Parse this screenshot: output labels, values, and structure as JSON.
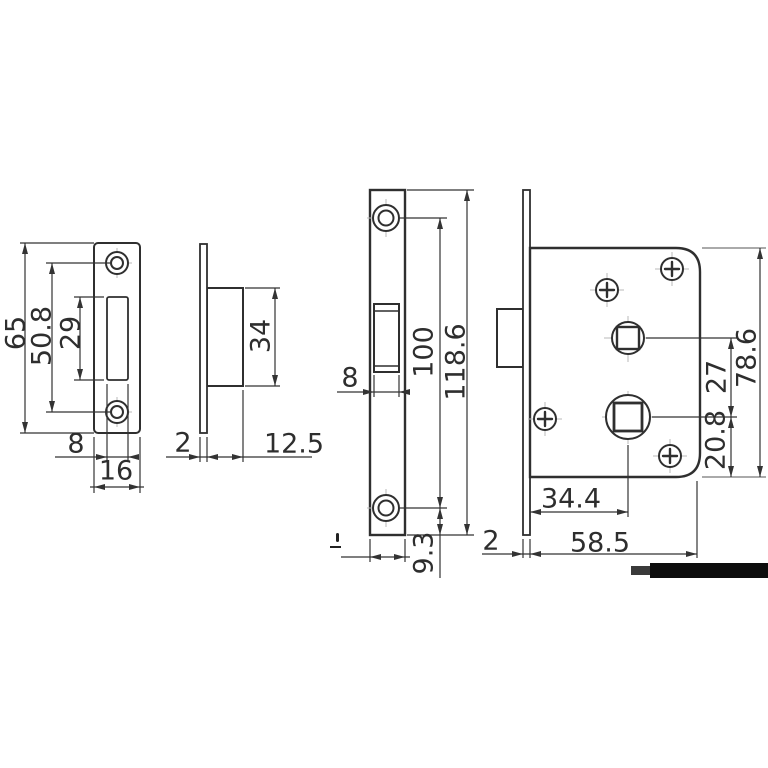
{
  "drawing": {
    "views": {
      "strike_plate_front": {
        "height": "65",
        "screw_spacing": "50.8",
        "slot_height": "29",
        "slot_width": "8",
        "width": "16"
      },
      "strike_plate_side": {
        "box_height": "34",
        "plate_thickness": "2",
        "box_depth": "12.5"
      },
      "lock_faceplate_front": {
        "latch_width": "8",
        "screw_spacing": "100",
        "total_height": "118.6",
        "screw_edge_offset": "9.3"
      },
      "lock_body_side": {
        "spindle_spacing": "27",
        "body_height": "78.6",
        "spindle_bottom_offset": "20.8",
        "backset": "34.4",
        "faceplate_thickness": "2",
        "body_depth": "58.5"
      }
    },
    "colors": {
      "line": "#333333",
      "outline": "#2f2f2f",
      "centerline": "#b8b8b8",
      "background": "#ffffff",
      "redaction": "#0d0d0d"
    }
  }
}
